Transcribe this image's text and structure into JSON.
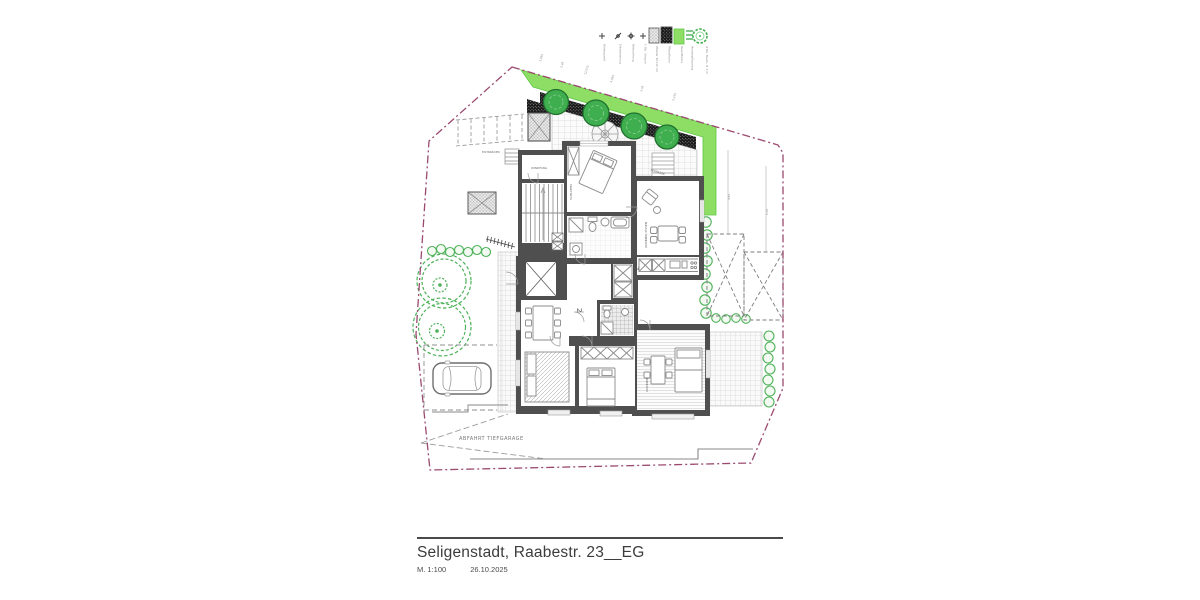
{
  "title_block": {
    "title": "Seligenstadt, Raabestr. 23__EG",
    "scale": "M. 1:100",
    "date": "26.10.2025"
  },
  "plan": {
    "ramp_label": "ABFAHRT TIEFGARAGE",
    "bike_label": "FAHRRÄDER",
    "terrace_label": "TERRASSE",
    "windfang_label": "WINDFANG",
    "unit_left": "2",
    "unit_right": "7",
    "room_schlafen": "SCHLAFEN",
    "room_wohnen_essen": "WOHNEN / ESSEN",
    "room_wohnen": "WOHNEN",
    "dims_top": [
      "3.495",
      "2.26",
      "12.015",
      "4.385",
      "3.76",
      "5.235"
    ],
    "dims_right": [
      "4.50",
      "6.20"
    ]
  },
  "legend": {
    "items": [
      {
        "symbol": "elevation-marker",
        "label": "Höhenpunkt"
      },
      {
        "symbol": "drain-marker",
        "label": "Entwässerung"
      },
      {
        "symbol": "light-marker",
        "label": "Beleuchtung"
      },
      {
        "symbol": "shrub-marker",
        "label": "1 Stk. Strauch"
      },
      {
        "symbol": "paving-swatch",
        "label": "Pflaster 10×20 cm"
      },
      {
        "symbol": "planting-swatch",
        "label": "Pflanzfläche"
      },
      {
        "symbol": "lawn-swatch",
        "label": "Rasenfläche"
      },
      {
        "symbol": "hedge-swatch",
        "label": "Heckenpflanzung"
      },
      {
        "symbol": "tree-symbol",
        "label": "4 Stk. Baum, H. 3 m"
      }
    ]
  },
  "colors": {
    "wall": "#4f4f4f",
    "lawn": "#8ede65",
    "lawn_edge": "#5ec743",
    "tree": "#3fae4e",
    "tree_edge": "#20702f",
    "hedge": "#4db158",
    "boundary": "#9a4a70",
    "tile_line": "#c9c9c9",
    "furniture": "#8b8b8b",
    "planting_dark": "#1b1b1b",
    "text_gray": "#707070",
    "title_text": "#3c3c3c"
  }
}
